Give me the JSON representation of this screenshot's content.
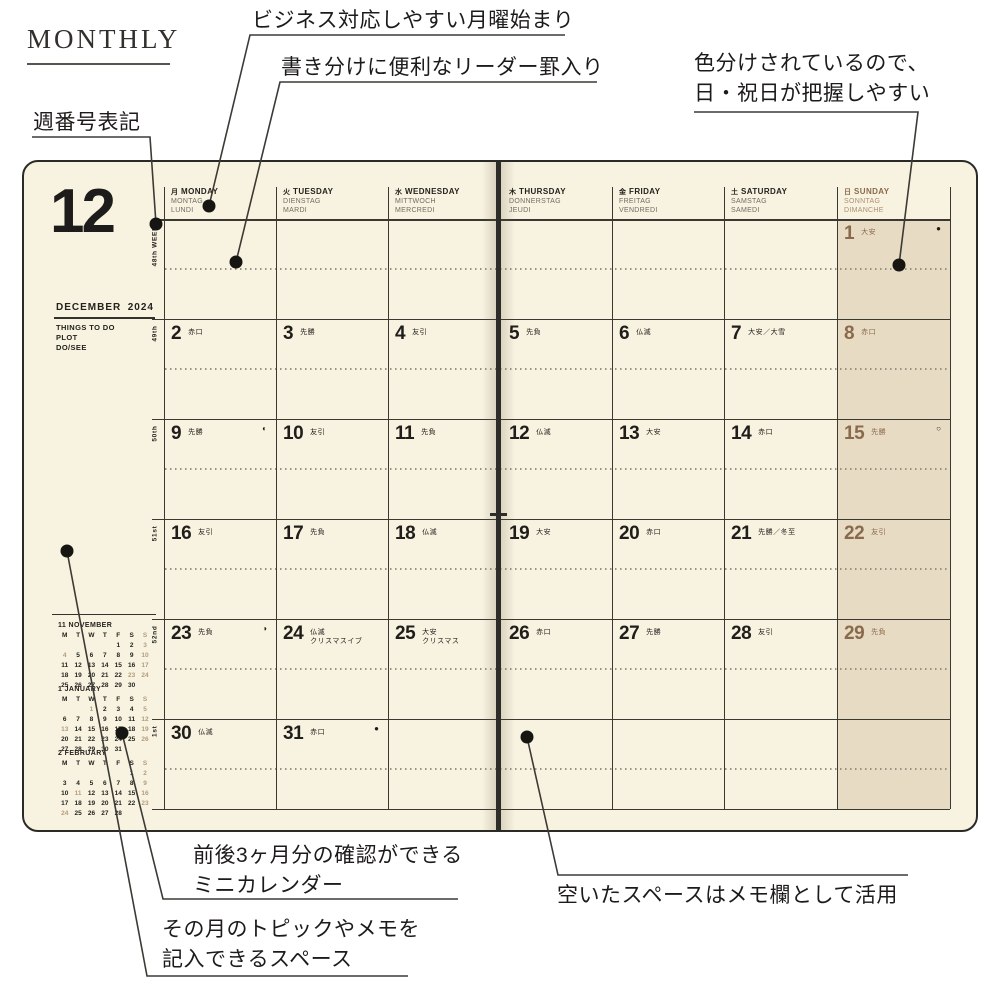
{
  "page_title": "MONTHLY",
  "annotations": {
    "monday_start": "ビジネス対応しやすい月曜始まり",
    "leader_rule": "書き分けに便利なリーダー罫入り",
    "color_coded_line1": "色分けされているので、",
    "color_coded_line2": "日・祝日が把握しやすい",
    "week_number": "週番号表記",
    "mini_calendar_line1": "前後3ヶ月分の確認ができる",
    "mini_calendar_line2": "ミニカレンダー",
    "topic_space_line1": "その月のトピックやメモを",
    "topic_space_line2": "記入できるスペース",
    "memo_space": "空いたスペースはメモ欄として活用"
  },
  "planner": {
    "month_number": "12",
    "month_name": "DECEMBER",
    "year": "2024",
    "todo_lines": [
      "THINGS TO DO",
      "PLOT",
      "DO/SEE"
    ],
    "weekday_header": [
      {
        "kanji": "月",
        "en": "MONDAY",
        "de": "MONTAG",
        "fr": "LUNDI",
        "sunday": false
      },
      {
        "kanji": "火",
        "en": "TUESDAY",
        "de": "DIENSTAG",
        "fr": "MARDI",
        "sunday": false
      },
      {
        "kanji": "水",
        "en": "WEDNESDAY",
        "de": "MITTWOCH",
        "fr": "MERCREDI",
        "sunday": false
      },
      {
        "kanji": "木",
        "en": "THURSDAY",
        "de": "DONNERSTAG",
        "fr": "JEUDI",
        "sunday": false
      },
      {
        "kanji": "金",
        "en": "FRIDAY",
        "de": "FREITAG",
        "fr": "VENDREDI",
        "sunday": false
      },
      {
        "kanji": "土",
        "en": "SATURDAY",
        "de": "SAMSTAG",
        "fr": "SAMEDI",
        "sunday": false
      },
      {
        "kanji": "日",
        "en": "SUNDAY",
        "de": "SONNTAG",
        "fr": "DIMANCHE",
        "sunday": true
      }
    ],
    "week_labels": [
      "48th WEEK",
      "49th",
      "50th",
      "51st",
      "52nd",
      "1st"
    ],
    "days": [
      {
        "row": 0,
        "col": 6,
        "date": "1",
        "rokuyo": "大安",
        "moon": "●"
      },
      {
        "row": 1,
        "col": 0,
        "date": "2",
        "rokuyo": "赤口"
      },
      {
        "row": 1,
        "col": 1,
        "date": "3",
        "rokuyo": "先勝"
      },
      {
        "row": 1,
        "col": 2,
        "date": "4",
        "rokuyo": "友引"
      },
      {
        "row": 1,
        "col": 3,
        "date": "5",
        "rokuyo": "先負"
      },
      {
        "row": 1,
        "col": 4,
        "date": "6",
        "rokuyo": "仏滅"
      },
      {
        "row": 1,
        "col": 5,
        "date": "7",
        "rokuyo": "大安／大雪"
      },
      {
        "row": 1,
        "col": 6,
        "date": "8",
        "rokuyo": "赤口"
      },
      {
        "row": 2,
        "col": 0,
        "date": "9",
        "rokuyo": "先勝",
        "moon": "◐"
      },
      {
        "row": 2,
        "col": 1,
        "date": "10",
        "rokuyo": "友引"
      },
      {
        "row": 2,
        "col": 2,
        "date": "11",
        "rokuyo": "先負"
      },
      {
        "row": 2,
        "col": 3,
        "date": "12",
        "rokuyo": "仏滅"
      },
      {
        "row": 2,
        "col": 4,
        "date": "13",
        "rokuyo": "大安"
      },
      {
        "row": 2,
        "col": 5,
        "date": "14",
        "rokuyo": "赤口"
      },
      {
        "row": 2,
        "col": 6,
        "date": "15",
        "rokuyo": "先勝",
        "moon": "○"
      },
      {
        "row": 3,
        "col": 0,
        "date": "16",
        "rokuyo": "友引"
      },
      {
        "row": 3,
        "col": 1,
        "date": "17",
        "rokuyo": "先負"
      },
      {
        "row": 3,
        "col": 2,
        "date": "18",
        "rokuyo": "仏滅"
      },
      {
        "row": 3,
        "col": 3,
        "date": "19",
        "rokuyo": "大安"
      },
      {
        "row": 3,
        "col": 4,
        "date": "20",
        "rokuyo": "赤口"
      },
      {
        "row": 3,
        "col": 5,
        "date": "21",
        "rokuyo": "先勝／冬至"
      },
      {
        "row": 3,
        "col": 6,
        "date": "22",
        "rokuyo": "友引"
      },
      {
        "row": 4,
        "col": 0,
        "date": "23",
        "rokuyo": "先負",
        "moon": "◑"
      },
      {
        "row": 4,
        "col": 1,
        "date": "24",
        "rokuyo": "仏滅",
        "note": "クリスマスイブ"
      },
      {
        "row": 4,
        "col": 2,
        "date": "25",
        "rokuyo": "大安",
        "note": "クリスマス"
      },
      {
        "row": 4,
        "col": 3,
        "date": "26",
        "rokuyo": "赤口"
      },
      {
        "row": 4,
        "col": 4,
        "date": "27",
        "rokuyo": "先勝"
      },
      {
        "row": 4,
        "col": 5,
        "date": "28",
        "rokuyo": "友引"
      },
      {
        "row": 4,
        "col": 6,
        "date": "29",
        "rokuyo": "先負"
      },
      {
        "row": 5,
        "col": 0,
        "date": "30",
        "rokuyo": "仏滅"
      },
      {
        "row": 5,
        "col": 1,
        "date": "31",
        "rokuyo": "赤口",
        "moon": "●"
      }
    ],
    "mini_calendars": [
      {
        "title": "11 NOVEMBER",
        "header": [
          "M",
          "T",
          "W",
          "T",
          "F",
          "S",
          "S"
        ],
        "weeks": [
          [
            "",
            "",
            "",
            "",
            "1",
            "2",
            "3"
          ],
          [
            "4",
            "5",
            "6",
            "7",
            "8",
            "9",
            "10"
          ],
          [
            "11",
            "12",
            "13",
            "14",
            "15",
            "16",
            "17"
          ],
          [
            "18",
            "19",
            "20",
            "21",
            "22",
            "23",
            "24"
          ],
          [
            "25",
            "26",
            "27",
            "28",
            "29",
            "30",
            ""
          ]
        ],
        "light_dates": [
          "3",
          "4",
          "10",
          "17",
          "23",
          "24"
        ]
      },
      {
        "title": "1 JANUARY",
        "header": [
          "M",
          "T",
          "W",
          "T",
          "F",
          "S",
          "S"
        ],
        "weeks": [
          [
            "",
            "",
            "1",
            "2",
            "3",
            "4",
            "5"
          ],
          [
            "6",
            "7",
            "8",
            "9",
            "10",
            "11",
            "12"
          ],
          [
            "13",
            "14",
            "15",
            "16",
            "17",
            "18",
            "19"
          ],
          [
            "20",
            "21",
            "22",
            "23",
            "24",
            "25",
            "26"
          ],
          [
            "27",
            "28",
            "29",
            "30",
            "31",
            "",
            ""
          ]
        ],
        "light_dates": [
          "1",
          "5",
          "12",
          "13",
          "19",
          "26"
        ]
      },
      {
        "title": "2 FEBRUARY",
        "header": [
          "M",
          "T",
          "W",
          "T",
          "F",
          "S",
          "S"
        ],
        "weeks": [
          [
            "",
            "",
            "",
            "",
            "",
            "1",
            "2"
          ],
          [
            "3",
            "4",
            "5",
            "6",
            "7",
            "8",
            "9"
          ],
          [
            "10",
            "11",
            "12",
            "13",
            "14",
            "15",
            "16"
          ],
          [
            "17",
            "18",
            "19",
            "20",
            "21",
            "22",
            "23"
          ],
          [
            "24",
            "25",
            "26",
            "27",
            "28",
            "",
            ""
          ]
        ],
        "light_dates": [
          "2",
          "9",
          "11",
          "16",
          "23",
          "24"
        ]
      }
    ],
    "colors": {
      "page_bg": "#f8f3e0",
      "sunday_bg": "#e7dbc3",
      "sunday_text": "#8a6a4c",
      "grid_line": "#3a3831",
      "ink": "#1d1c1a"
    }
  }
}
